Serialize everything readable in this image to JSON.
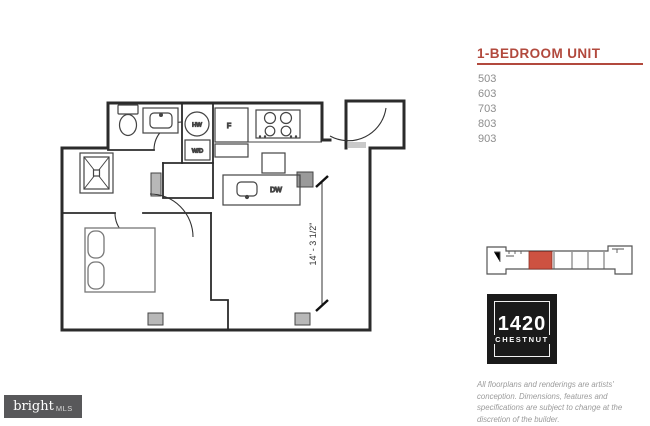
{
  "panel": {
    "title": "1-BEDROOM UNIT",
    "accent_color": "#b2493d",
    "units": [
      "503",
      "603",
      "703",
      "803",
      "903"
    ]
  },
  "keyplan": {
    "highlight_color": "#cd5241"
  },
  "floorplan": {
    "labels": {
      "hw": "HW",
      "wd": "W/D",
      "fridge": "F",
      "dw": "DW"
    },
    "dimension": "14' - 3 1/2\""
  },
  "logo": {
    "line1": "1420",
    "line2": "CHESTNUT"
  },
  "disclaimer": "All floorplans and renderings are artists' conception. Dimensions, features and specifications are subject to change at the discretion of the builder.",
  "brand": {
    "name": "bright",
    "suffix": "MLS"
  }
}
